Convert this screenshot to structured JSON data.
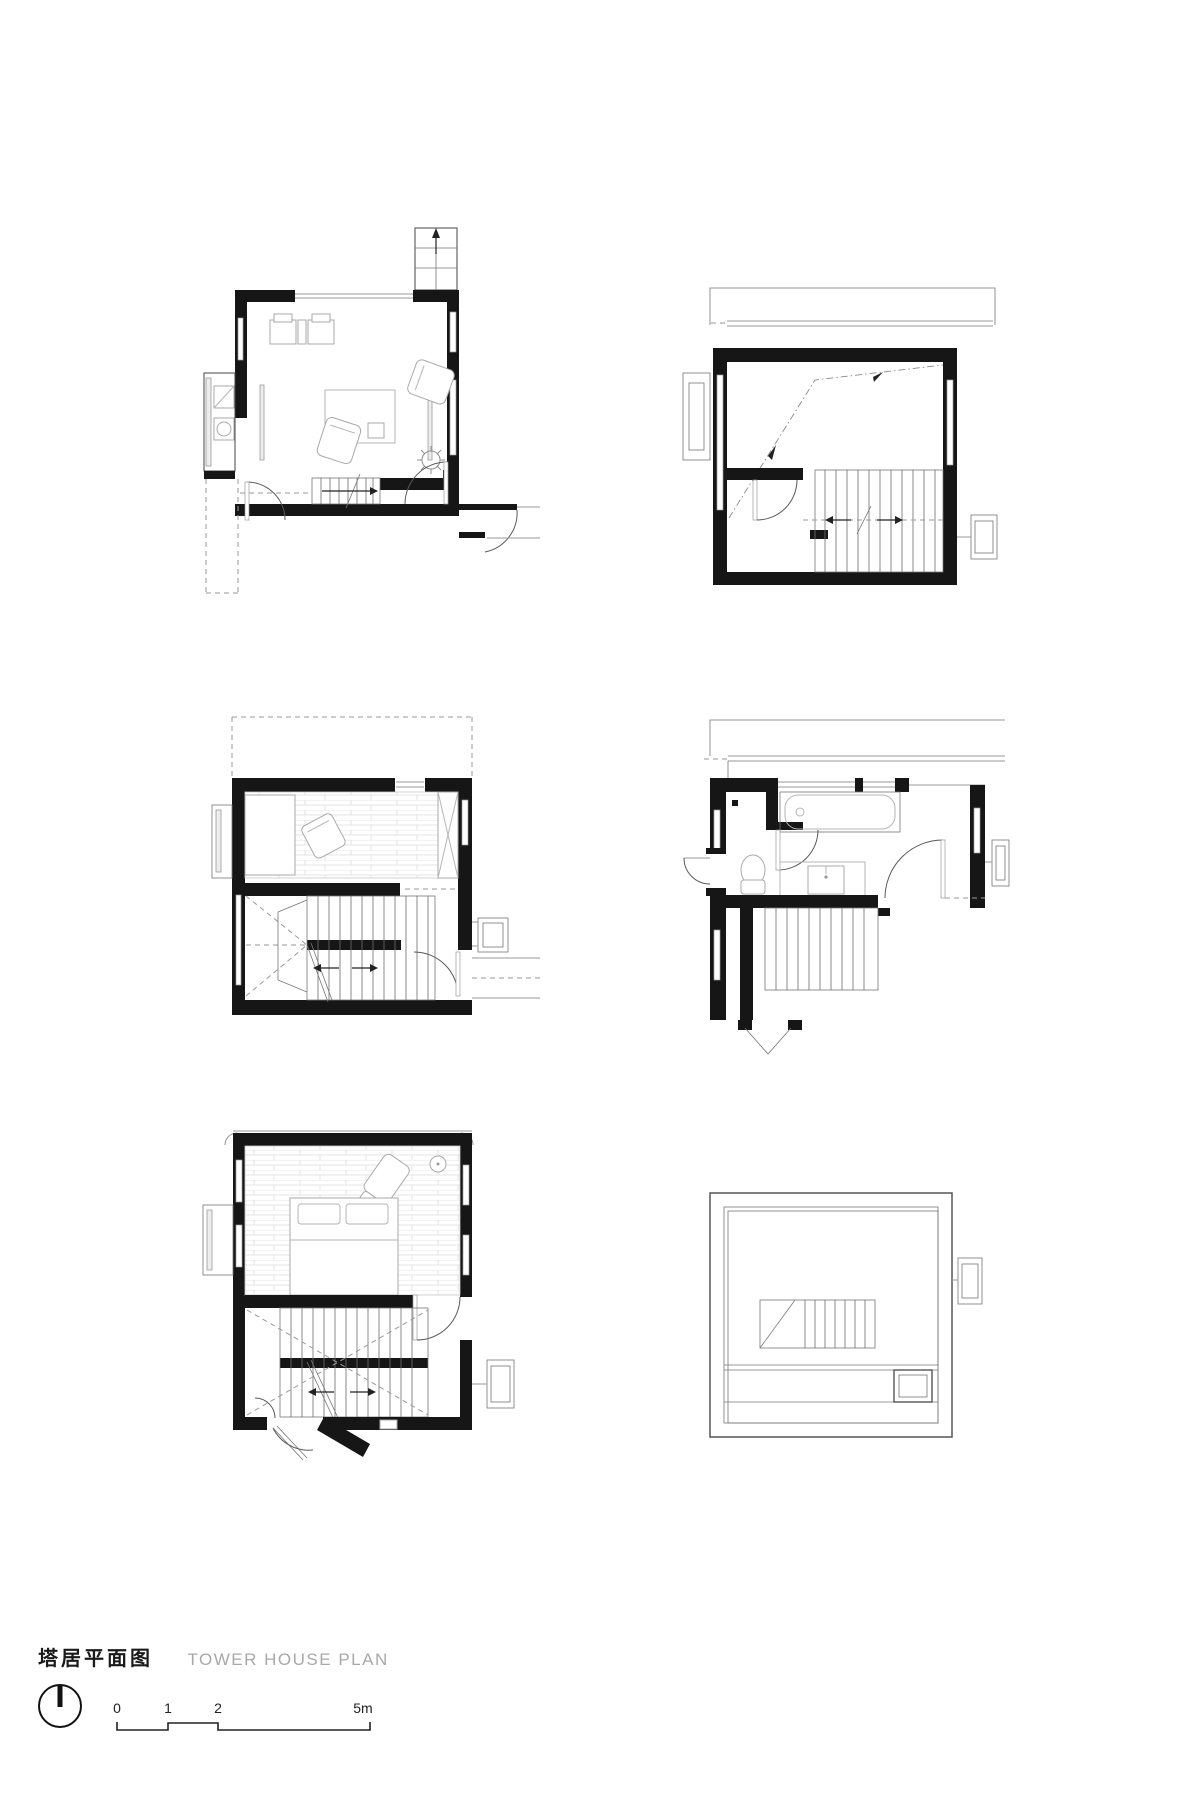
{
  "title": {
    "zh": "塔居平面图",
    "en": "TOWER HOUSE PLAN"
  },
  "scale_bar": {
    "labels": [
      "0",
      "1",
      "2",
      "5m"
    ]
  },
  "icons": {
    "north_arrow": "north-arrow-icon"
  },
  "colors": {
    "ink": "#1a1a1a",
    "title_en_gray": "#a8a8a8",
    "furniture_gray": "#a9a9a9",
    "dashed_gray": "#9a9a9a",
    "plank_gray": "#dcdcdc",
    "background": "#ffffff"
  }
}
